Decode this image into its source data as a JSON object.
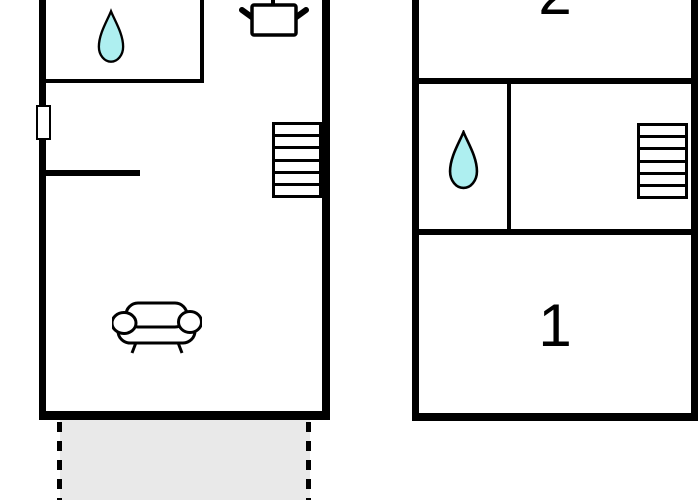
{
  "colors": {
    "wall": "#000000",
    "background": "#ffffff",
    "water_drop_fill": "#aeeff0",
    "water_drop_stroke": "#000000",
    "terrace_fill": "#e9e9e9"
  },
  "upper_floor": {
    "room_labels": {
      "top": "2",
      "bottom": "1"
    }
  },
  "icons": {
    "ground_floor": [
      "water-drop-icon",
      "cooking-pot-icon",
      "stairs-icon",
      "sofa-icon",
      "window-marker"
    ],
    "upper_floor": [
      "water-drop-icon",
      "stairs-icon"
    ]
  }
}
